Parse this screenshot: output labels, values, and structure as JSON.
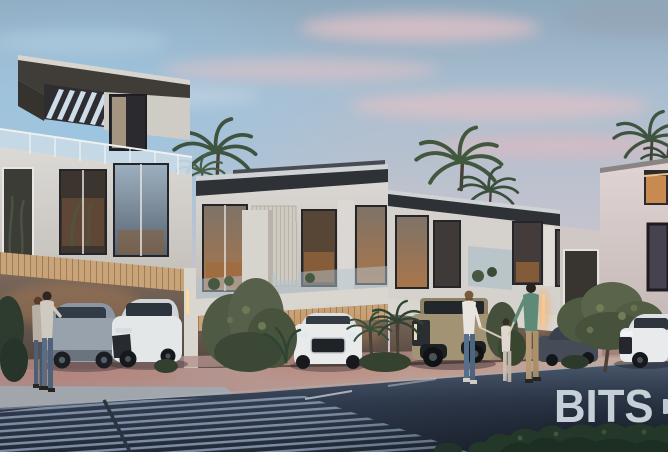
{
  "watermark": {
    "label": "BITS"
  },
  "palette": {
    "sky_top": "#8ea8bc",
    "sky_pink": "#d2c2c9",
    "cloud_pink": "#ddc1c7",
    "facade_light": "#d6d3cf",
    "roof_dark": "#2e3136",
    "warm_window": "#a3703f",
    "carport_wall": "#6e5d4f",
    "pavement_pink": "#b4918d",
    "sidewalk_gray": "#a0a8b0",
    "road_dark": "#2e3848",
    "crosswalk_stripe": "#8b9cb3",
    "hedge_green": "#243829",
    "palm_green": "#42583e",
    "watermark_text": "#d0d8df"
  },
  "scene": {
    "setting": "modern-townhouse-row-at-dusk",
    "elements": [
      "rooftop-pergola-villa",
      "two-story-townhouses",
      "palm-trees",
      "parked-cars",
      "pedestrians",
      "carport-lights",
      "crosswalk",
      "street",
      "hedge"
    ],
    "cars": [
      "silver-suv",
      "white-crossover",
      "white-audi-suv",
      "sand-offroad-truck",
      "dark-pickup",
      "white-suv-right"
    ],
    "people": [
      "couple-left",
      "woman-walking",
      "child-walking",
      "man-walking"
    ]
  }
}
